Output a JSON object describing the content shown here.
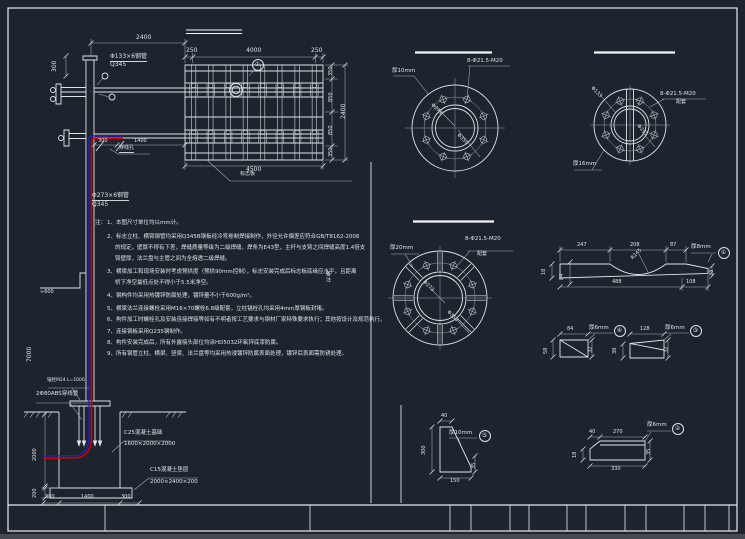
{
  "canvas": {
    "bg": "#1e242e",
    "line": "#dfe3e8",
    "dim": "#c6ccd3",
    "red": "#d40000",
    "blue": "#1f1fd4"
  },
  "main": {
    "arm_spec": "Φ133×6钢管",
    "arm_grade": "Q345",
    "pole_spec": "Φ273×6钢管",
    "pole_grade": "Q345",
    "balloon_top": "①",
    "panel_label": "标志板",
    "wire_hole_label": "穿线孔",
    "dims": {
      "top_span": "2400",
      "top_left": "300",
      "panel_top_left": "250",
      "panel_top_mid": "4000",
      "panel_top_right": "250",
      "panel_bottom": "4500",
      "panel_side": [
        "350",
        "850",
        "850",
        "350"
      ],
      "panel_side_total": "2400",
      "arm_a": "300",
      "arm_b": "1400",
      "pole_height": "7000",
      "ground_offset": "≈600"
    }
  },
  "notes": {
    "title": "注：",
    "lines": [
      "1、本图尺寸单位均以mm计。",
      "2、标志立柱、横臂钢管均采用Q345B钢板经冷弯卷制焊接制作，外径允许偏差应符合GB/T8162-2008",
      "的规定，壁厚不得有下差，焊缝质量等级为二级焊缝，焊条为E43型，主杆与支臂之间焊缝高度1.4倍支",
      "臂壁厚，法兰盘与主管之间为全熔透二级焊缝。",
      "3、横梁加工和现场安装时考虑预拱度（预拱90mm控制），标志安装完成后标志板底缘应水平，且距离",
      "桥下净空最低点处不得小于5.5米净空。",
      "4、钢构件均采用热镀锌防腐处理，镀锌量不小于600g/m²。",
      "5、横梁法兰连接螺栓采用M16×70螺栓6.8级配套，立柱锚栓孔均采用4mm厚钢板封堵。",
      "6、构件加工时螺栓孔及安装连接焊接等如有不明者按工艺要求与钢材厂家特殊要求执行；其他按设计及规范执行。",
      "7、连接钢板采用Q235钢制作。",
      "8、构件安装完成后，所有外露接头部位均涂HD5032环氧锌底漆防腐。",
      "9、所有钢管立柱、横梁、竖梁、法兰盘等均采用热浸镀锌防腐表面处理，镀锌后表面需防锈处理。"
    ]
  },
  "side_note": "备注",
  "foundation": {
    "anchor_label": "锚栓M24 L=1000",
    "conduit_label": "2Φ80ABS穿线管",
    "base_name": "C25混凝土基础",
    "base_size": "1600×2000×2000",
    "cushion_name": "C15混凝土垫层",
    "cushion_size": "2000×2400×200",
    "dims": {
      "bottom": [
        "300",
        "1400",
        "300"
      ],
      "depth": "2000",
      "cushion_thk": "200"
    }
  },
  "flanges": {
    "a": {
      "thickness": "厚10mm",
      "holes": "8-Φ21.5-M20",
      "inner": "Φ273",
      "outer": "Φ350"
    },
    "b": {
      "thickness": "厚16mm",
      "holes": "8-Φ21.5-M20",
      "holes2": "配套",
      "tube": "Φ133",
      "inner": "Φ245"
    },
    "c": {
      "thickness": "厚20mm",
      "holes": "8-Φ21.5-M20",
      "holes2": "配套",
      "inner": "Φ273",
      "outer": "Φ350"
    }
  },
  "details": {
    "d1": {
      "thickness": "厚8mm",
      "num": "①",
      "dims": {
        "w1": "247",
        "w2": "208",
        "w3": "87",
        "b1": "488",
        "b2": "108",
        "h1": "18",
        "h2": "84",
        "h3": "38",
        "r": "R245"
      }
    },
    "d2": {
      "thickness": "厚6mm",
      "num": "②",
      "dims": {
        "t1": "40",
        "t2": "270",
        "b": "330",
        "l": "18",
        "r": "35"
      }
    },
    "d3": {
      "thickness": "厚6mm",
      "num": "③",
      "dims": {
        "t": "128",
        "l": "38",
        "r": "32"
      }
    },
    "d4": {
      "thickness": "厚6mm",
      "num": "④",
      "dims": {
        "t": "84",
        "l": "58",
        "r": "32"
      }
    },
    "d5": {
      "thickness": "厚10mm",
      "num": "⑤",
      "dims": {
        "t": "40",
        "l": "300",
        "b": "150",
        "r": "35"
      }
    }
  }
}
